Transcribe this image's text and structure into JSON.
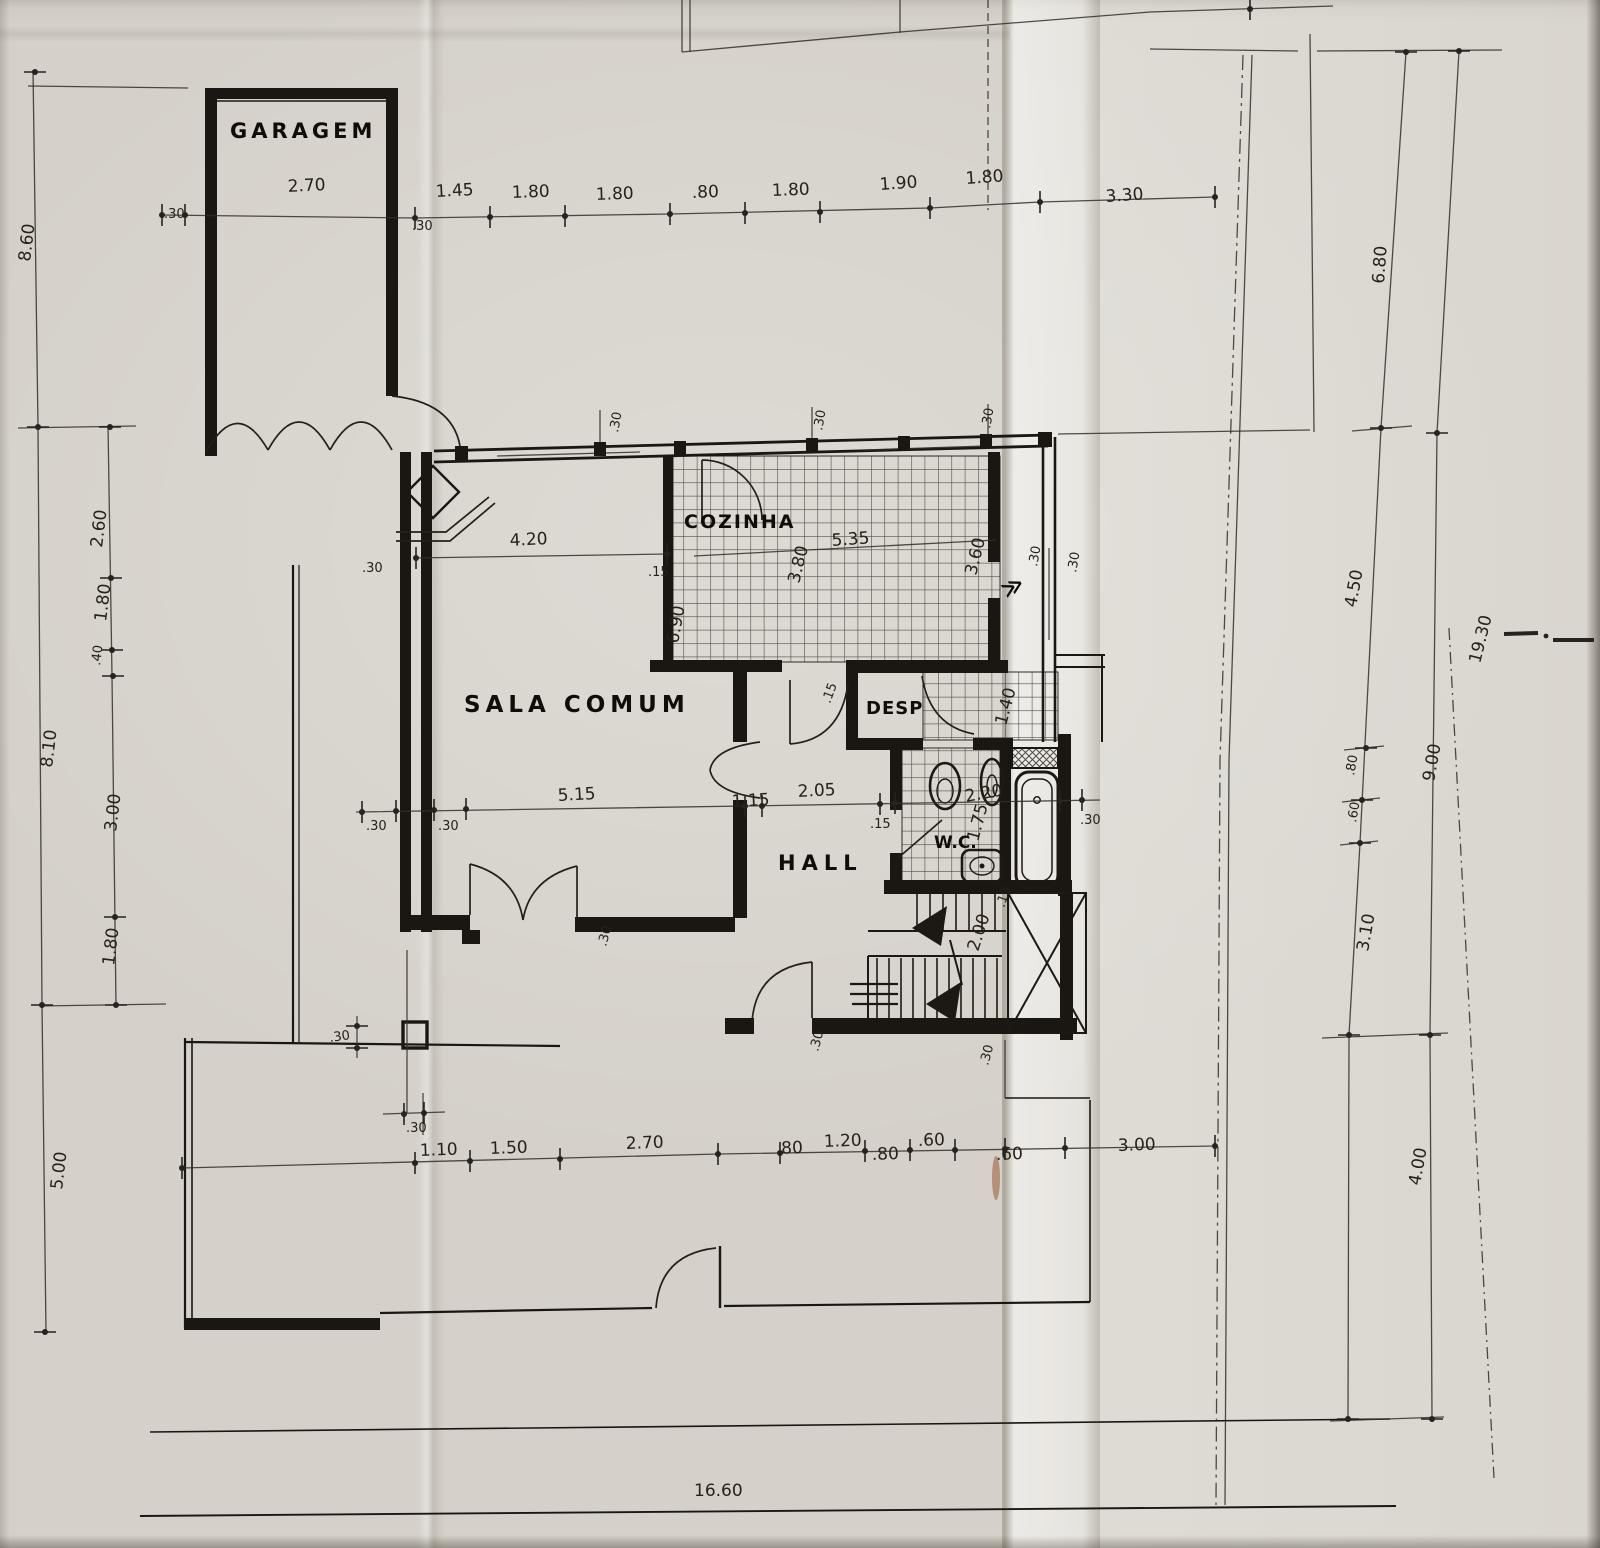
{
  "rooms": {
    "garagem": "GARAGEM",
    "sala": "SALA COMUM",
    "cozinha": "COZINHA",
    "desp": "DESP",
    "wc": "W.C.",
    "hall": "HALL"
  },
  "dims_top": [
    "2.70",
    ".30",
    ".30",
    "1.45",
    "1.80",
    "1.80",
    ".80",
    "1.80",
    "1.90",
    "1.80",
    "3.30"
  ],
  "dims_left": [
    "8.60",
    "2.60",
    "1.80",
    ".40",
    "8.10",
    "3.00",
    "1.80",
    "5.00"
  ],
  "dims_right": [
    "6.80",
    "4.50",
    ".80",
    ".60",
    "3.10",
    "9.00",
    "4.00",
    "19.30"
  ],
  "dims_bottom": [
    ".30",
    "1.10",
    "1.50",
    "2.70",
    ".80",
    "1.20",
    ".80",
    ".60",
    ".60",
    "3.00"
  ],
  "dims_overall": {
    "bottom_total": "16.60"
  },
  "dims_sala": [
    "4.20",
    ".30",
    ".15",
    "6.90",
    "5.15",
    ".30",
    ".30",
    ".30",
    ".30"
  ],
  "dims_cozinha": [
    "5.35",
    "3.80",
    "3.60",
    ".30",
    ".30",
    ".30",
    ".30",
    ".30"
  ],
  "dims_hall": [
    "1.15",
    "2.05",
    ".15",
    ".15",
    "1.40",
    ".30",
    ".30",
    ".30"
  ],
  "dims_wc": [
    "2.20",
    "1.75"
  ],
  "dims_stairs": [
    "2.00",
    ".13"
  ],
  "symbols": {
    "window_marker": "≫"
  }
}
